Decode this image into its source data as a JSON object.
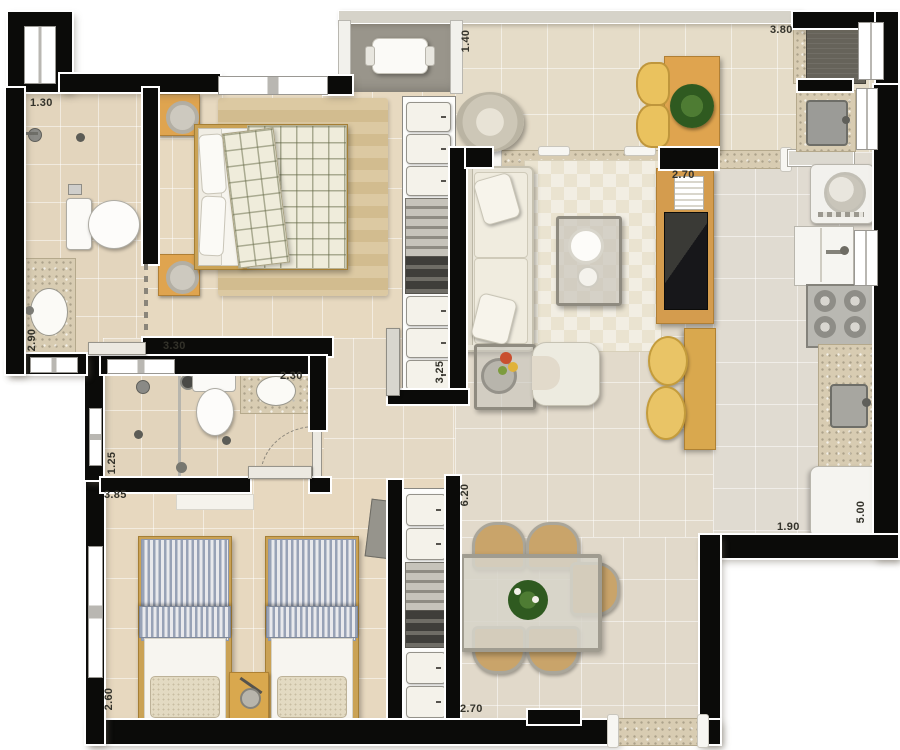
{
  "meta": {
    "type": "apartment-floor-plan-top-view",
    "units": "meters"
  },
  "dimension_labels": [
    {
      "id": "bathroom1-width",
      "text": "1.30",
      "orientation": "horizontal"
    },
    {
      "id": "bathroom1-depth",
      "text": "2.90",
      "orientation": "vertical"
    },
    {
      "id": "bedroom1-width",
      "text": "3.30",
      "orientation": "horizontal"
    },
    {
      "id": "balcony-depth",
      "text": "1.40",
      "orientation": "vertical"
    },
    {
      "id": "terrace-width",
      "text": "3.80",
      "orientation": "horizontal"
    },
    {
      "id": "tv-wall-width",
      "text": "2.70",
      "orientation": "horizontal"
    },
    {
      "id": "closet1-length",
      "text": "3.25",
      "orientation": "vertical"
    },
    {
      "id": "bathroom2-width",
      "text": "2.30",
      "orientation": "horizontal"
    },
    {
      "id": "bathroom2-depth",
      "text": "1.25",
      "orientation": "vertical"
    },
    {
      "id": "bedroom2-width",
      "text": "3.85",
      "orientation": "horizontal"
    },
    {
      "id": "bedroom2-depth",
      "text": "2.60",
      "orientation": "vertical"
    },
    {
      "id": "living-length",
      "text": "6.20",
      "orientation": "vertical"
    },
    {
      "id": "dining-width",
      "text": "2.70",
      "orientation": "horizontal"
    },
    {
      "id": "kitchen-width",
      "text": "1.90",
      "orientation": "horizontal"
    },
    {
      "id": "kitchen-length",
      "text": "5.00",
      "orientation": "vertical"
    }
  ],
  "rooms": [
    "bathroom-1",
    "bedroom-1",
    "balcony",
    "terrace-living",
    "service-area",
    "kitchen",
    "hall",
    "bathroom-2",
    "bedroom-2",
    "dining-area"
  ],
  "furniture": [
    "double-bed",
    "nightstand",
    "wardrobe-closet",
    "toilet",
    "vanity-sink",
    "shower",
    "sofa",
    "pouf",
    "coffee-table",
    "armchair",
    "side-table",
    "tv-rack",
    "tv",
    "breakfast-bar",
    "bar-stool",
    "terrace-table",
    "terrace-chair",
    "plant",
    "laundry-tank",
    "washing-machine",
    "kitchen-sink",
    "stove",
    "counter",
    "fridge",
    "single-bed",
    "dining-table",
    "dining-chair",
    "balcony-bench"
  ],
  "colors": {
    "wall": "#0b0b09",
    "floor_warm": "#e6d7bd",
    "floor_cool": "#e0dbd1",
    "balcony_gray": "#99958b",
    "granite": "#d8ccb2",
    "wood": "#dfa44f",
    "bar_wood": "#d9a84e",
    "stool_yellow": "#e9c466",
    "chair_tan": "#c9a46a",
    "plant_green": "#3f6d2c",
    "blanket_plaid": "#efecdb",
    "bed_stripe_blue": "#98a2b6",
    "sofa_cream": "#e9e5d8",
    "tv_dark": "#23231f"
  }
}
